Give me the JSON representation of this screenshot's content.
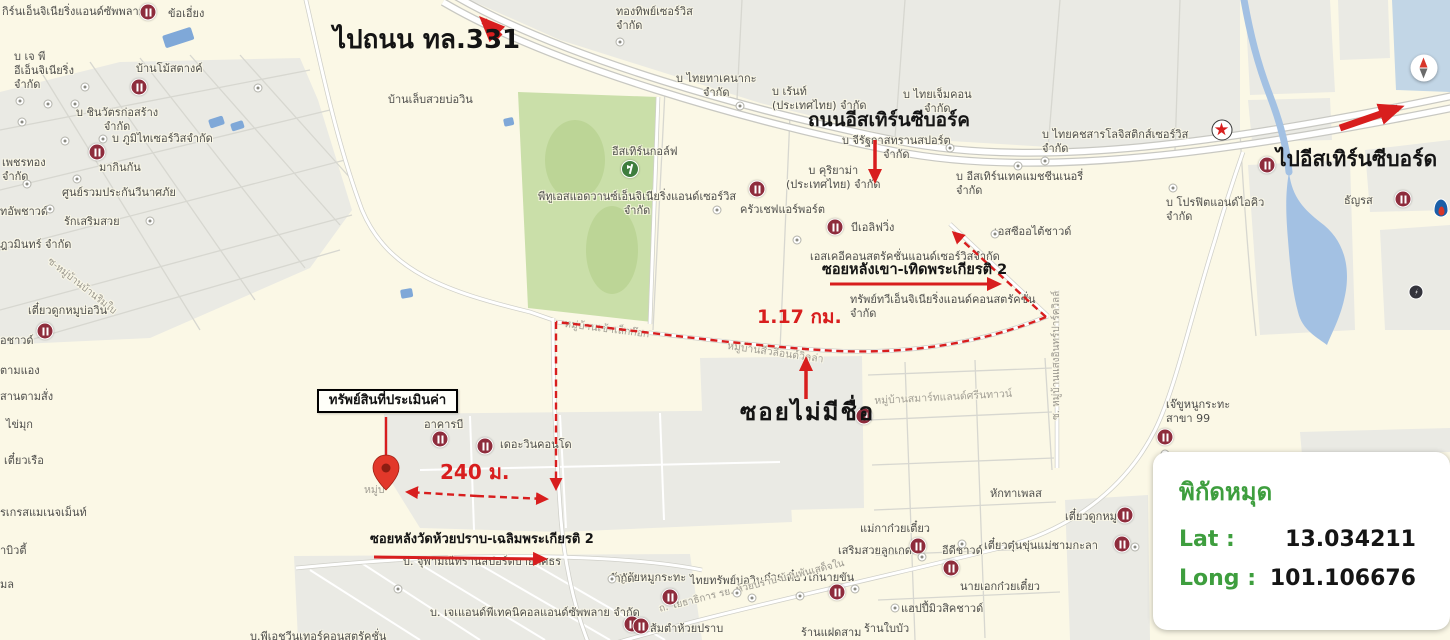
{
  "map_overlay": {
    "to_road_331": "ไปถนน ทล.331",
    "eastern_seaboard_road": "ถนนอีสเทิร์นซีบอร์ค",
    "to_eastern_seaboard": "ไปอีสเทิร์นซีบอร์ด",
    "soi_lang_khao": "ซอยหลังเขา-เทิดพระเกียรติ 2",
    "distance_soi": "1.17 กม.",
    "soi_no_name": "ซอยไม่มีชื่อ",
    "property_box": "ทรัพย์สินที่ประเมินค่า",
    "distance_property": "240 ม.",
    "soi_wat_huai_prap": "ซอยหลังวัดห้วยปราบ-เฉลิมพระเกียรติ 2"
  },
  "coordinates_panel": {
    "title": "พิกัดหมุด",
    "lat_label": "Lat :",
    "lat_value": "13.034211",
    "long_label": "Long :",
    "long_value": "101.106676"
  },
  "colors": {
    "annotation_red": "#d81e1e",
    "panel_green": "#3e9e3e",
    "map_background": "#fbf8e6",
    "block_gray": "#eaeae4",
    "golf_green": "#cadfa9",
    "water_blue": "#a3c1e3",
    "poi_maroon": "#8e2c3c"
  },
  "map_labels": [
    {
      "t": "กิร์นเอ็นจิเนียริ่งแอนด์ซัพพลาย",
      "x": 2,
      "y": 5
    },
    {
      "t": "ข้อเอี่ยง",
      "x": 168,
      "y": 7
    },
    {
      "t": "บ เจ พี\nอีเอ็นจิเนียริ่ง\nจำกัด",
      "x": 14,
      "y": 50
    },
    {
      "t": "บ้านโม้สตางค์",
      "x": 136,
      "y": 62
    },
    {
      "t": "บ ชินวัตรก่อสร้าง\nจำกัด",
      "x": 76,
      "y": 106,
      "ta": "c"
    },
    {
      "t": "บ ภูมิไทเซอร์วิสจำกัด",
      "x": 112,
      "y": 132
    },
    {
      "t": "เพชรทอง\nจำกัด",
      "x": 2,
      "y": 156
    },
    {
      "t": "มากินกัน",
      "x": 99,
      "y": 161
    },
    {
      "t": "ศูนย์รวมประกันวีนาศภัย",
      "x": 62,
      "y": 186
    },
    {
      "t": "ทอัพชาวด์",
      "x": 0,
      "y": 205
    },
    {
      "t": "รักเสริมสวย",
      "x": 64,
      "y": 215
    },
    {
      "t": "ฎวมินทร์ จำกัด",
      "x": 0,
      "y": 238
    },
    {
      "t": "เตี๋ยวดูกหมูบ่อวิน",
      "x": 28,
      "y": 304
    },
    {
      "t": "อชาวด์",
      "x": 0,
      "y": 334
    },
    {
      "t": "ตามแอง",
      "x": 0,
      "y": 364
    },
    {
      "t": "สานตามสั่ง",
      "x": 0,
      "y": 390
    },
    {
      "t": "ไข่มุก",
      "x": 6,
      "y": 418
    },
    {
      "t": "เตี๋ยวเรือ",
      "x": 4,
      "y": 454
    },
    {
      "t": "รเกรสแมเนจเม็นท์",
      "x": 0,
      "y": 506
    },
    {
      "t": "าบิวตี้",
      "x": 0,
      "y": 544
    },
    {
      "t": "มล",
      "x": 0,
      "y": 578
    },
    {
      "t": "ทองทิพย์เซอร์วิส\nจำกัด",
      "x": 616,
      "y": 5
    },
    {
      "t": "บ้านเล็บสวยบ่อวิน",
      "x": 388,
      "y": 93
    },
    {
      "t": "บ ไทยทาเคนากะ\nจำกัด",
      "x": 676,
      "y": 72,
      "ta": "c"
    },
    {
      "t": "บ เร้นท์\n(ประเทศไทย) จำกัด",
      "x": 772,
      "y": 85
    },
    {
      "t": "บ ไทยเจ็มคอน\nจำกัด",
      "x": 903,
      "y": 88,
      "ta": "c"
    },
    {
      "t": "บ ไทยคชสารโลจิสติกส์เซอร์วิส\nจำกัด",
      "x": 1042,
      "y": 128
    },
    {
      "t": "อีสเทิร์นกอล์ฟ",
      "x": 612,
      "y": 145
    },
    {
      "t": "พีทูเอสแอดวานซ์เอ็นจิเนียริ่งแอนด์เซอร์วิส\nจำกัด",
      "x": 538,
      "y": 190,
      "ta": "c"
    },
    {
      "t": "บ จีรัฐกาสทรานสปอร์ต\nจำกัด",
      "x": 842,
      "y": 134,
      "ta": "c"
    },
    {
      "t": "บ คุริยาม่า\n(ประเทศไทย) จำกัด",
      "x": 786,
      "y": 164,
      "ta": "c"
    },
    {
      "t": "บ อีสเทิร์นเทคแมชชีนเนอรี่\nจำกัด",
      "x": 956,
      "y": 170
    },
    {
      "t": "ครัวเชฟแอร์พอร์ต",
      "x": 740,
      "y": 203
    },
    {
      "t": "บีเอลิฟวิ่ง",
      "x": 851,
      "y": 221
    },
    {
      "t": "เอสซีออไต้ชาวด์",
      "x": 994,
      "y": 225
    },
    {
      "t": "เอสเคอีคอนสตรัคชั่นแอนด์เซอร์วิสจำกัด",
      "x": 810,
      "y": 250
    },
    {
      "t": "ทรัพย์ทวีเอ็นจิเนียริ่งแอนด์คอนสตรัคชั่น\nจำกัด",
      "x": 850,
      "y": 293
    },
    {
      "t": "บ โปรฟิตแอนด์ไอคิว\nจำกัด",
      "x": 1166,
      "y": 196
    },
    {
      "t": "ธัญรส",
      "x": 1344,
      "y": 194
    },
    {
      "t": "เจ๊ขูหนูกระทะ\nสาขา 99",
      "x": 1166,
      "y": 398
    },
    {
      "t": "หักทาเพลส",
      "x": 990,
      "y": 487
    },
    {
      "t": "เตี๋ยวดูกหมู",
      "x": 1065,
      "y": 510
    },
    {
      "t": "เตี๋ยวตุ๋นขุ่นแม่ชามกะลา",
      "x": 984,
      "y": 539
    },
    {
      "t": "แม่กาก๋วยเตี๋ยว",
      "x": 860,
      "y": 522
    },
    {
      "t": "เสริมสวยลูกเกด",
      "x": 838,
      "y": 544
    },
    {
      "t": "อีดีชาวด์",
      "x": 942,
      "y": 544
    },
    {
      "t": "นายเอกก๋วยเตี๋ยว",
      "x": 960,
      "y": 580
    },
    {
      "t": "แฮปปี้มิวสิคชาวด์",
      "x": 901,
      "y": 602
    },
    {
      "t": "ก๋วยเตี๋ยวไก่นายขัน",
      "x": 764,
      "y": 571
    },
    {
      "t": "ไทยทรัพย์บ่อวิน",
      "x": 690,
      "y": 574
    },
    {
      "t": "สัญชัยหมูกระทะ",
      "x": 610,
      "y": 571
    },
    {
      "t": "ส้มตำห้วยปราบ",
      "x": 650,
      "y": 622
    },
    {
      "t": "ร้านแฝดสาม",
      "x": 801,
      "y": 626
    },
    {
      "t": "ร้านใบบัว",
      "x": 864,
      "y": 622
    },
    {
      "t": "บ. จุฬามณีทรานสปอร์ตบายศศธร",
      "x": 403,
      "y": 555
    },
    {
      "t": "จำกัด",
      "x": 608,
      "y": 572
    },
    {
      "t": "บ. เจเแอนด์พีเทคนิคอลแอนด์ซัพพลาย จำกัด",
      "x": 430,
      "y": 606
    },
    {
      "t": "บ.พีเอชวีนเทอร์คอนสตรัคชั่น",
      "x": 250,
      "y": 630
    },
    {
      "t": "อาคารบี",
      "x": 424,
      "y": 418
    },
    {
      "t": "เดอะวินคอนโด",
      "x": 500,
      "y": 438
    },
    {
      "t": "หมู่บ้านสมาร์ทแลนด์ศรีนทาวน์",
      "x": 874,
      "y": 395,
      "c": "v",
      "rot": -3
    },
    {
      "t": "ซ. หมู่บ้านแสงอินทร์ปาร์ควิลล์",
      "x": 1051,
      "y": 420,
      "c": "r",
      "rot": -90
    },
    {
      "t": "ถ. โยธาธิการ รย. ห้วยปราบ-บ้านพันเสด็จใน",
      "x": 658,
      "y": 604,
      "c": "r",
      "rot": -14
    },
    {
      "t": "ซ-หมู่บ้านบ้านริมใบ",
      "x": 52,
      "y": 256,
      "c": "r",
      "rot": 38
    },
    {
      "t": "หมู่บ้านเข้าเล็กก๊อก",
      "x": 565,
      "y": 318,
      "c": "v",
      "rot": 7
    },
    {
      "t": "หมู่บ้านสีวลีอนด์วิลล่า",
      "x": 728,
      "y": 340,
      "c": "v",
      "rot": 8
    },
    {
      "t": "หมู่บ",
      "x": 364,
      "y": 484,
      "c": "v"
    }
  ],
  "poi": [
    {
      "type": "restaurant",
      "x": 148,
      "y": 12
    },
    {
      "type": "restaurant",
      "x": 139,
      "y": 87
    },
    {
      "type": "restaurant",
      "x": 97,
      "y": 152
    },
    {
      "type": "restaurant",
      "x": 45,
      "y": 331
    },
    {
      "type": "restaurant",
      "x": 757,
      "y": 189
    },
    {
      "type": "restaurant",
      "x": 835,
      "y": 227
    },
    {
      "type": "restaurant",
      "x": 440,
      "y": 439
    },
    {
      "type": "restaurant",
      "x": 485,
      "y": 446
    },
    {
      "type": "restaurant",
      "x": 670,
      "y": 597
    },
    {
      "type": "restaurant",
      "x": 632,
      "y": 624
    },
    {
      "type": "restaurant",
      "x": 641,
      "y": 626
    },
    {
      "type": "restaurant",
      "x": 918,
      "y": 546
    },
    {
      "type": "restaurant",
      "x": 951,
      "y": 568
    },
    {
      "type": "restaurant",
      "x": 837,
      "y": 592
    },
    {
      "type": "restaurant",
      "x": 1125,
      "y": 515
    },
    {
      "type": "restaurant",
      "x": 1122,
      "y": 544
    },
    {
      "type": "restaurant",
      "x": 1165,
      "y": 437
    },
    {
      "type": "restaurant",
      "x": 1267,
      "y": 165
    },
    {
      "type": "restaurant",
      "x": 1403,
      "y": 199
    },
    {
      "type": "restaurant",
      "x": 864,
      "y": 416
    },
    {
      "type": "dot",
      "x": 620,
      "y": 42
    },
    {
      "type": "dot",
      "x": 740,
      "y": 106
    },
    {
      "type": "dot",
      "x": 85,
      "y": 87
    },
    {
      "type": "dot",
      "x": 258,
      "y": 88
    },
    {
      "type": "dot",
      "x": 20,
      "y": 101
    },
    {
      "type": "dot",
      "x": 48,
      "y": 104
    },
    {
      "type": "dot",
      "x": 75,
      "y": 104
    },
    {
      "type": "dot",
      "x": 22,
      "y": 122
    },
    {
      "type": "dot",
      "x": 103,
      "y": 139
    },
    {
      "type": "dot",
      "x": 65,
      "y": 141
    },
    {
      "type": "dot",
      "x": 77,
      "y": 179
    },
    {
      "type": "dot",
      "x": 27,
      "y": 184
    },
    {
      "type": "dot",
      "x": 50,
      "y": 209
    },
    {
      "type": "dot",
      "x": 150,
      "y": 221
    },
    {
      "type": "dot",
      "x": 717,
      "y": 210
    },
    {
      "type": "dot",
      "x": 950,
      "y": 148
    },
    {
      "type": "dot",
      "x": 1018,
      "y": 166
    },
    {
      "type": "dot",
      "x": 1045,
      "y": 161
    },
    {
      "type": "dot",
      "x": 1173,
      "y": 188
    },
    {
      "type": "dot",
      "x": 797,
      "y": 240
    },
    {
      "type": "dot",
      "x": 995,
      "y": 234
    },
    {
      "type": "dot",
      "x": 922,
      "y": 557
    },
    {
      "type": "dot",
      "x": 855,
      "y": 589
    },
    {
      "type": "dot",
      "x": 737,
      "y": 593
    },
    {
      "type": "dot",
      "x": 752,
      "y": 598
    },
    {
      "type": "dot",
      "x": 800,
      "y": 596
    },
    {
      "type": "dot",
      "x": 895,
      "y": 608
    },
    {
      "type": "dot",
      "x": 612,
      "y": 579
    },
    {
      "type": "dot",
      "x": 398,
      "y": 589
    },
    {
      "type": "dot",
      "x": 1135,
      "y": 547
    },
    {
      "type": "dot",
      "x": 1165,
      "y": 454
    },
    {
      "type": "dot",
      "x": 962,
      "y": 544
    },
    {
      "type": "golf",
      "x": 630,
      "y": 169
    },
    {
      "type": "caltex",
      "x": 1222,
      "y": 112
    },
    {
      "type": "compass",
      "x": 1424,
      "y": 29
    },
    {
      "type": "flame",
      "x": 1441,
      "y": 142
    },
    {
      "type": "bolt",
      "x": 1416,
      "y": 207
    }
  ]
}
